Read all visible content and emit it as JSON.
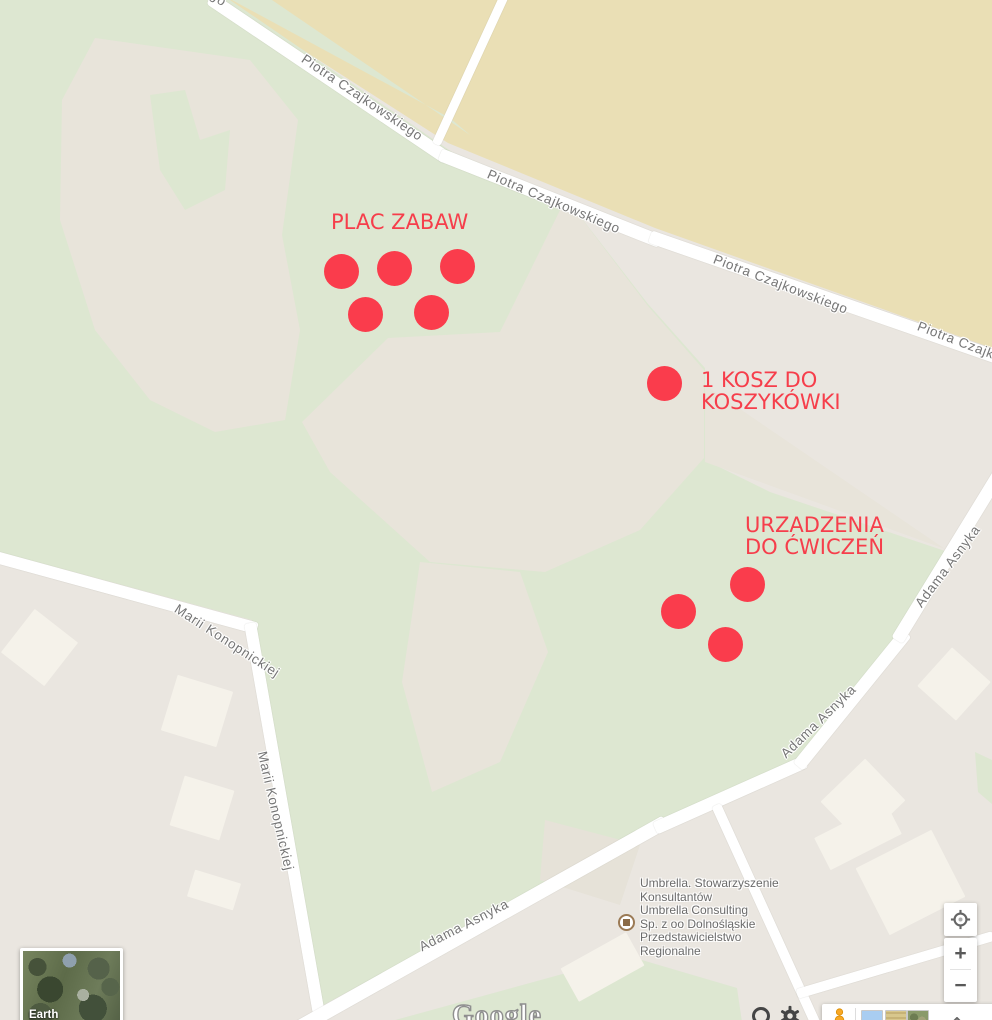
{
  "streets": {
    "piotra_czajkowskiego": "Piotra Czajkowskiego",
    "marii_konopnickiej": "Marii Konopnickiej",
    "adama_asnyka": "Adama Asnyka",
    "fragment_go": "go"
  },
  "annotations": {
    "plac_zabaw": {
      "label": "PLAC ZABAW",
      "marker_count": 5
    },
    "kosz": {
      "line1": "1 KOSZ DO",
      "line2": "KOSZYKÓWKI",
      "marker_count": 1
    },
    "urzadzenia": {
      "line1": "URZADZENIA",
      "line2": "DO ĆWICZEŃ",
      "marker_count": 3
    }
  },
  "poi": {
    "lines": [
      "Umbrella. Stowarzyszenie",
      "Konsultantów",
      "Umbrella Consulting",
      "Sp. z oo Dolnośląskie",
      "Przedstawicielstwo",
      "Regionalne"
    ]
  },
  "controls": {
    "zoom_in": "+",
    "zoom_out": "−",
    "earth_label": "Earth",
    "google_logo": "Google"
  },
  "colors": {
    "marker_red": "#fa3c4c",
    "annotation_text_red": "#f63e4b",
    "park_green": "#dde7d1",
    "field_tan": "#eadfb5",
    "base_grey": "#eae6e0",
    "road_white": "#ffffff",
    "street_label_grey": "#767676",
    "building_white": "#f5f2ea"
  }
}
